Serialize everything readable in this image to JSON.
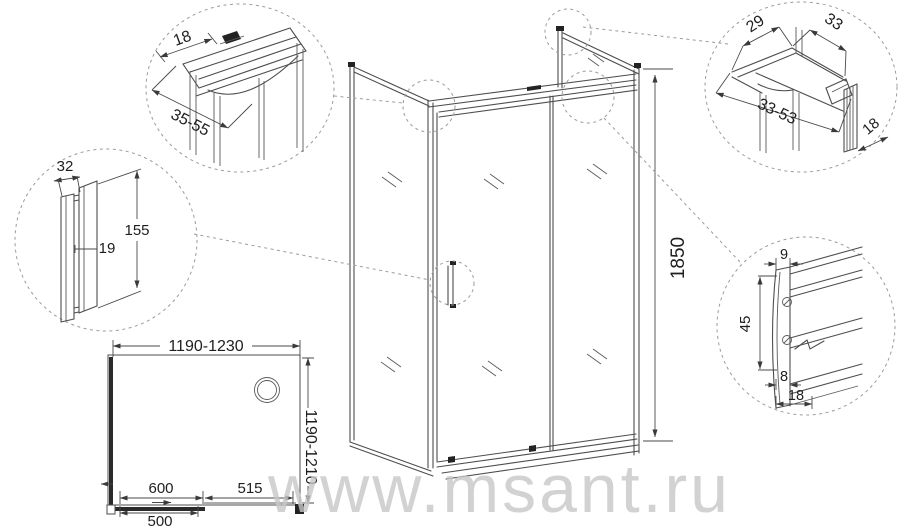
{
  "watermark": "www.msant.ru",
  "main": {
    "height": "1850"
  },
  "plan": {
    "width": "1190-1230",
    "depth": "1190-1210",
    "opening": "600",
    "fixed_panel": "515",
    "door_panel": "500"
  },
  "detail_top_left": {
    "profile_width": "18",
    "adjust_range": "35-55"
  },
  "detail_handle": {
    "width": "32",
    "length": "155",
    "gap": "19"
  },
  "detail_top_right": {
    "width_a": "29",
    "width_b": "33",
    "adjust_range": "33-53",
    "glass_gap": "18"
  },
  "detail_rail_profile": {
    "top_width": "9",
    "height": "45",
    "inner_width": "8",
    "depth": "18"
  }
}
